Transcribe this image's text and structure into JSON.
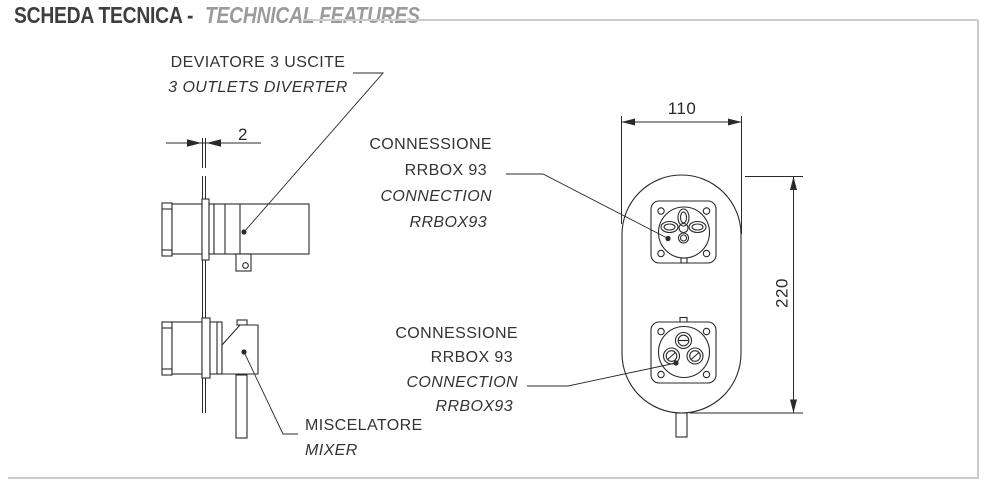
{
  "header": {
    "title_it": "SCHEDA TECNICA -",
    "title_en": "TECHNICAL FEATURES"
  },
  "labels": {
    "diverter": {
      "it": "DEVIATORE 3 USCITE",
      "en": "3 OUTLETS DIVERTER"
    },
    "connection_top": {
      "line1": "CONNESSIONE",
      "line2": "RRBOX 93",
      "line3": "CONNECTION",
      "line4": "RRBOX93"
    },
    "connection_bottom": {
      "line1": "CONNESSIONE",
      "line2": "RRBOX 93",
      "line3": "CONNECTION",
      "line4": "RRBOX93"
    },
    "mixer": {
      "it": "MISCELATORE",
      "en": "MIXER"
    }
  },
  "dimensions": {
    "wall_thickness": "2",
    "front_width": "110",
    "front_height": "220"
  },
  "colors": {
    "line": "#2a2a2a",
    "frame": "#cbcbcb",
    "title_dark": "#3f3f3f",
    "title_gray": "#9b9b9b"
  }
}
